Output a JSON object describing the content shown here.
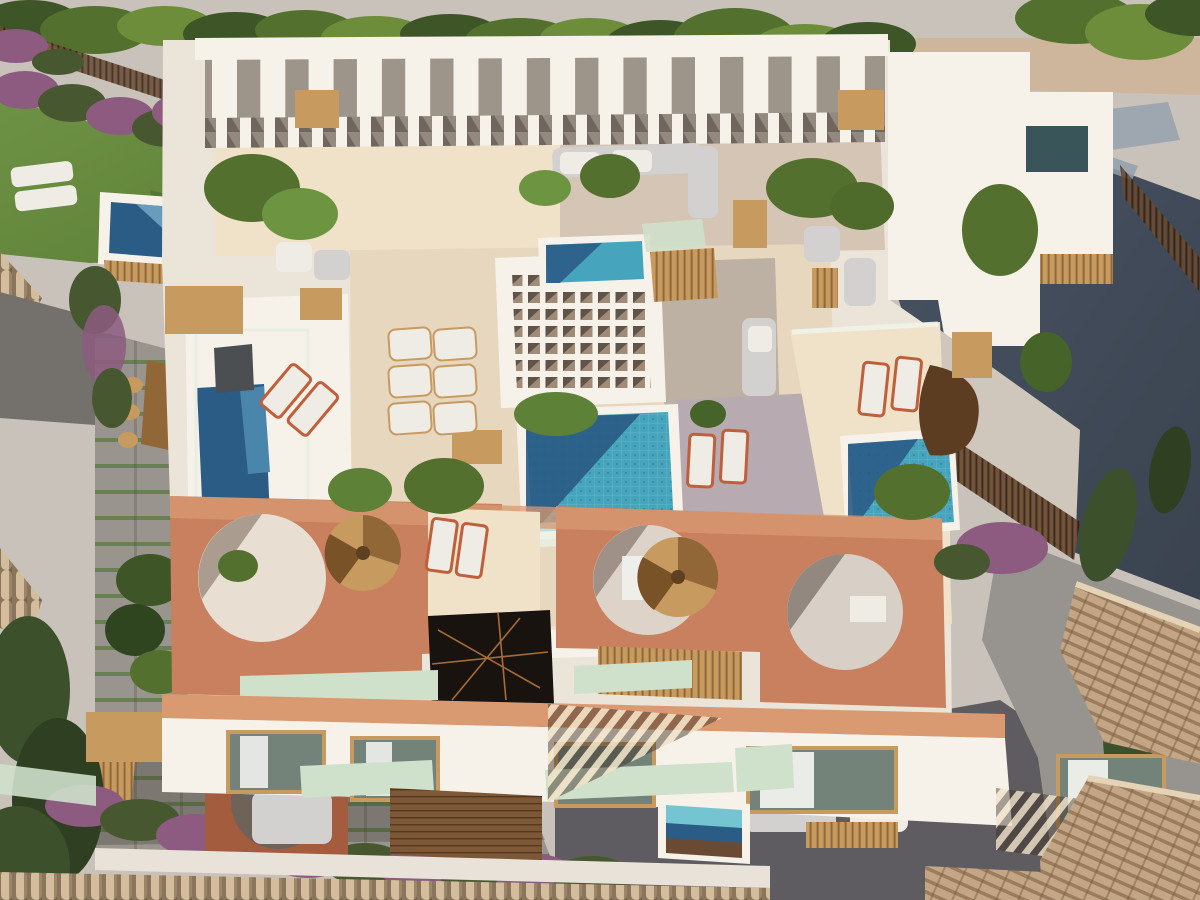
{
  "meta": {
    "type": "3d-architectural-aerial-render",
    "description": "Bird's-eye render of a modern Mediterranean apartment building with rooftop terraces, tiled pools, terracotta arch walls, a white waffle pergola, gardens with bougainvillea, a lawn, surrounding roads and neighbouring tiled roofs."
  },
  "palette": {
    "road-light": "#c9c2ba",
    "road-dark": "#434d5d",
    "road-stripe": "#93a0ad",
    "gravel": "#cdb69c",
    "hedge-dark": "#3e5527",
    "hedge-mid": "#53702e",
    "tree-light": "#6e8d3b",
    "lawn": "#5c7e38",
    "lawn-light": "#6e9244",
    "white-hi": "#f7f2e9",
    "white": "#ebe4d9",
    "white-shadow": "#cfc6bc",
    "shadow-cool": "#b3a79e",
    "cream-floor": "#e7d7bf",
    "cream-lit": "#f0e2c8",
    "cream-shade": "#c9b9ad",
    "lavender-shadow": "#b7abb1",
    "terracotta": "#c8805f",
    "terracotta-lit": "#d99a72",
    "terracotta-dark": "#a35c3d",
    "pool-deep": "#2a5c86",
    "pool-teal": "#46a5bd",
    "pool-light": "#74c5d1",
    "wood": "#c79a5f",
    "wood-dark": "#916738",
    "deck-brown": "#7d5836",
    "glass-green": "#cfe0cb",
    "glass-edge": "#eaf2e6",
    "marble": "#191310",
    "marble-vein": "#c07c3e",
    "sofa-gray": "#d3d1d0",
    "cushion-white": "#efece6",
    "orange-frame": "#bf5f3b",
    "paver": "#9a948e",
    "paver-shadow": "#74706c",
    "grass-joint": "#5d7a45",
    "roof-tile": "#c3a685",
    "roof-tile-dark": "#9b7c5e",
    "ridge-tile": "#d3bd9d",
    "bougainvillea": "#8d5a80",
    "bougainvillea-leaf": "#475830",
    "cypress": "#3c502b",
    "courtyard": "#97938f",
    "alley-dark": "#5e5c60",
    "skylight-teal": "#39555a",
    "window-glass": "#74837a",
    "curtain-white": "#f0f1ee",
    "waffle-dark": "#60534a"
  },
  "scene": {
    "features": [
      "top-road-with-hedge",
      "dark-shaded-street-right",
      "pergola-shadow-stripes-on-road",
      "white-rooftop-pergola-colonnade",
      "waffle-lattice-pergola",
      "central-tiled-pool",
      "small-terrace-pools",
      "left-lap-pool",
      "right-terrace-pool",
      "plunge-pools",
      "terracotta-terrace-with-circular-arches",
      "spiral-wood-staircases",
      "black-marble-feature-wall",
      "sun-loungers-white-orange",
      "outdoor-sofas",
      "potted-palms",
      "glass-balustrades",
      "green-glass-canopies",
      "garden-lawn",
      "bougainvillea-rows",
      "gray-paver-patio",
      "wooden-dining-set",
      "wooden-deck-and-stairs",
      "facade-windows-with-curtains",
      "barrel-tile-ridge-wall",
      "neighbour-tiled-roofs",
      "cypress-trees",
      "rooftop-skylight"
    ]
  }
}
